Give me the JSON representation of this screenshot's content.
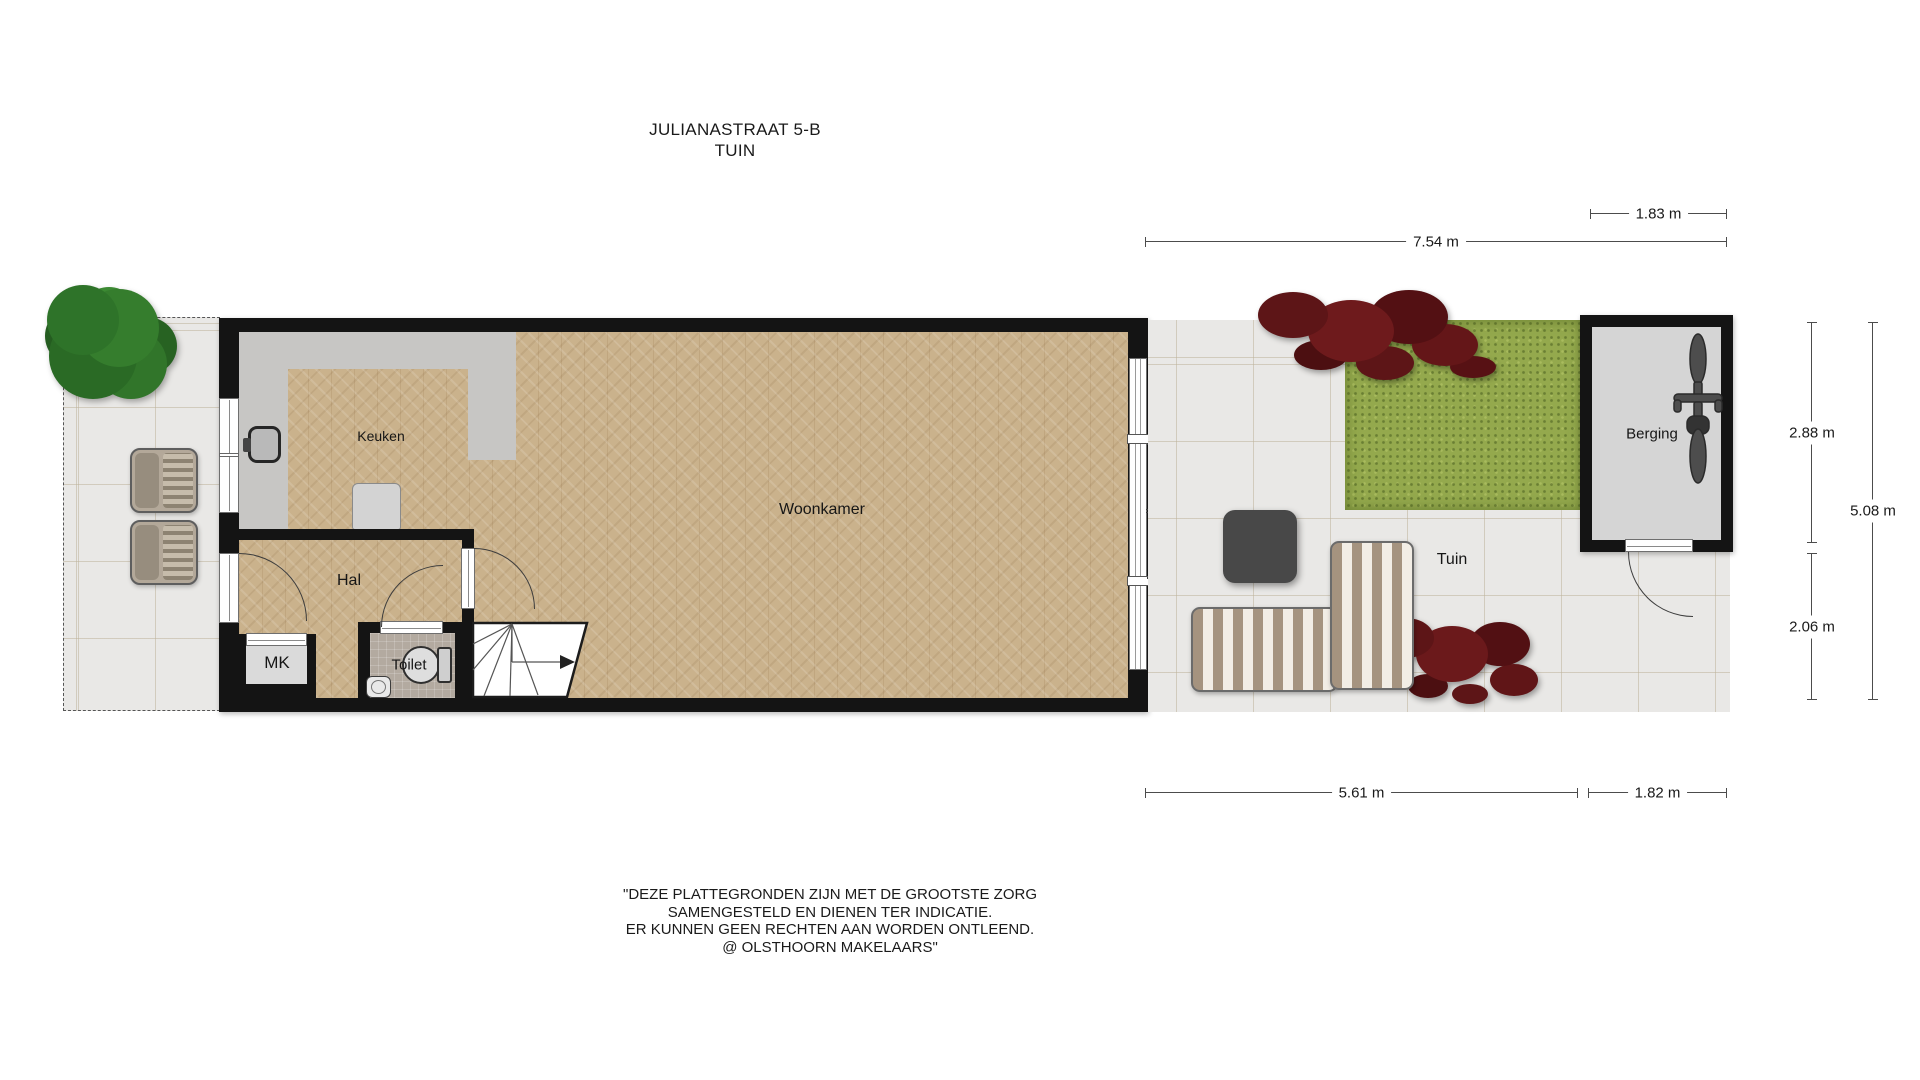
{
  "title": {
    "line1": "JULIANASTRAAT 5-B",
    "line2": "TUIN"
  },
  "rooms": {
    "keuken": "Keuken",
    "hal": "Hal",
    "mk": "MK",
    "toilet": "Toilet",
    "woonkamer": "Woonkamer",
    "tuin": "Tuin",
    "berging": "Berging"
  },
  "dimensions": {
    "garden_total_width": "7.54 m",
    "berging_width_top": "1.83 m",
    "garden_width_bottom": "5.61 m",
    "berging_width_bottom": "1.82 m",
    "berging_height": "2.88 m",
    "garden_lower_height": "2.06 m",
    "garden_total_height": "5.08 m"
  },
  "disclaimer": {
    "line1": "\"DEZE PLATTEGRONDEN ZIJN MET DE GROOTSTE ZORG",
    "line2": "SAMENGESTELD EN DIENEN TER INDICATIE.",
    "line3": "ER KUNNEN GEEN RECHTEN AAN WORDEN ONTLEEND.",
    "line4": "@ OLSTHOORN MAKELAARS\""
  },
  "objects": [
    "tree",
    "garden-chair",
    "garden-chair",
    "kitchen-sink",
    "kitchen-appliance",
    "toilet-bowl",
    "hand-basin",
    "stairs",
    "patio-table",
    "garden-sofa",
    "lounge-chair",
    "red-shrub",
    "red-shrub",
    "grass-patch",
    "bicycle"
  ],
  "colors": {
    "wall": "#141414",
    "wood_floor": "#cab28c",
    "kitchen_floor": "#c7c6c4",
    "outdoor_tile": "#e9e8e6",
    "toilet_tile": "#b3aaa0",
    "grass": "#94a94d",
    "shrub": "#5d1517",
    "sofa_stripe": "#a5937f",
    "table": "#484848",
    "tree": "#2e7329"
  }
}
